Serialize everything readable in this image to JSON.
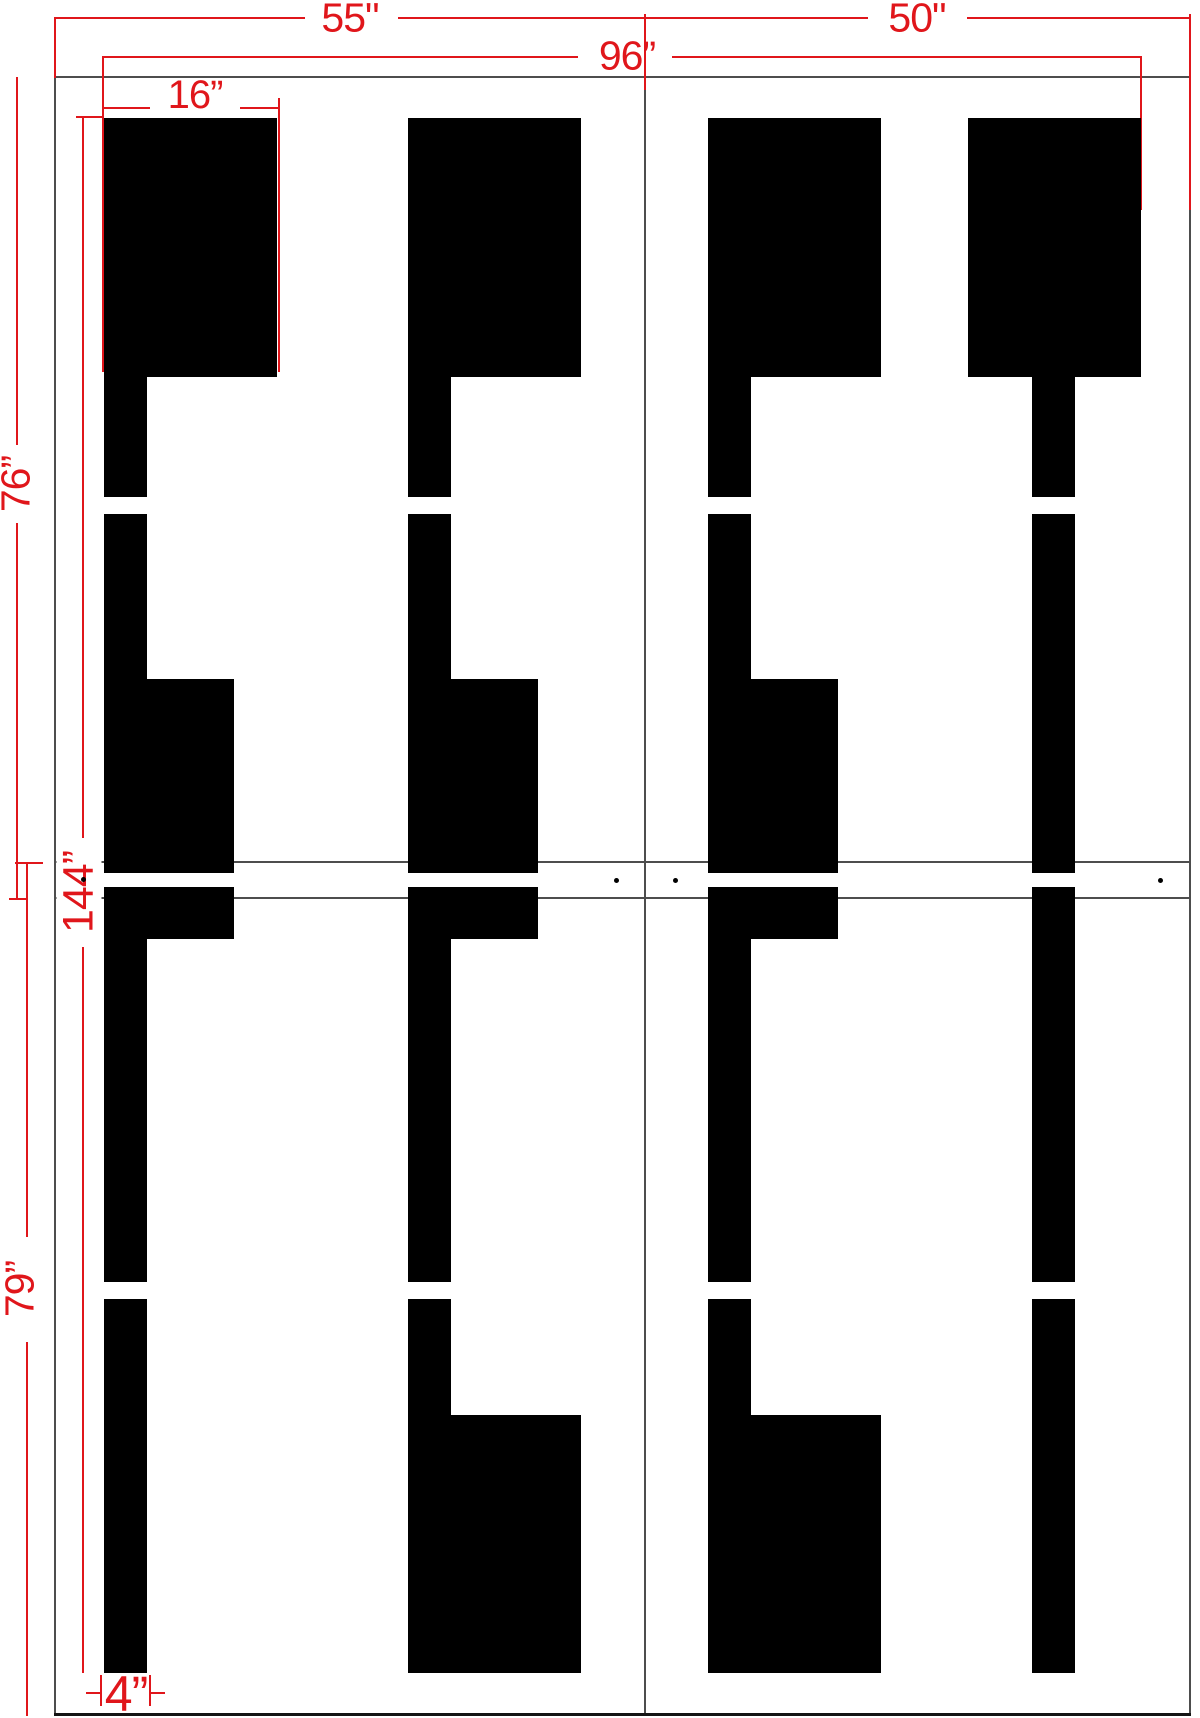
{
  "diagram": {
    "type": "stencil-dimension-drawing",
    "word": "FEET",
    "units": "inches",
    "canvas": {
      "w": 1200,
      "h": 1718
    },
    "colors": {
      "dimension_red": "#e0161b",
      "sheet_line_gray": "#4d4d4d",
      "bottom_edge_dark": "#141414",
      "shape_black": "#000000",
      "background": "#ffffff"
    },
    "dimension_labels": {
      "sheet_left_width": "55\"",
      "sheet_right_width": "50\"",
      "message_width": "96”",
      "letter_top_width": "16”",
      "top_sheet_height": "76”",
      "letter_height": "144”",
      "bottom_sheet_height": "79”",
      "letter_stroke_width": "4”"
    },
    "labels": [
      {
        "key": "sheet_left_width",
        "x": 350,
        "y": 18,
        "rot": 0,
        "size": 41,
        "bg": false
      },
      {
        "key": "sheet_right_width",
        "x": 917,
        "y": 18,
        "rot": 0,
        "size": 41,
        "bg": false
      },
      {
        "key": "message_width",
        "x": 627,
        "y": 56,
        "rot": 0,
        "size": 41,
        "bg": false
      },
      {
        "key": "letter_top_width",
        "x": 195,
        "y": 95,
        "rot": 0,
        "size": 40,
        "bg": false
      },
      {
        "key": "top_sheet_height",
        "x": 16,
        "y": 484,
        "rot": -90,
        "size": 41,
        "bg": true
      },
      {
        "key": "letter_height",
        "x": 79,
        "y": 892,
        "rot": -90,
        "size": 43,
        "bg": true
      },
      {
        "key": "bottom_sheet_height",
        "x": 20,
        "y": 1289,
        "rot": -90,
        "size": 41,
        "bg": true
      },
      {
        "key": "letter_stroke_width",
        "x": 126,
        "y": 1694,
        "rot": 0,
        "size": 50,
        "bg": false
      }
    ],
    "geometry": {
      "sheet_lines": [
        [
          54,
          76,
          1137,
          2
        ],
        [
          54,
          861,
          1137,
          2
        ],
        [
          54,
          897,
          1137,
          2
        ],
        [
          54,
          76,
          2,
          1640
        ],
        [
          644,
          76,
          2,
          1640
        ],
        [
          1189,
          76,
          2,
          1640
        ]
      ],
      "edge_lines": [
        [
          54,
          1713,
          1137,
          3
        ]
      ],
      "dim_lines": [
        [
          54,
          17,
          251,
          2
        ],
        [
          398,
          17,
          247,
          2
        ],
        [
          645,
          17,
          223,
          2
        ],
        [
          967,
          17,
          223,
          2
        ],
        [
          103,
          56,
          475,
          2
        ],
        [
          672,
          56,
          469,
          2
        ],
        [
          104,
          107,
          46,
          2
        ],
        [
          240,
          107,
          39,
          2
        ],
        [
          86,
          1692,
          14,
          2
        ],
        [
          151,
          1692,
          14,
          2
        ],
        [
          76,
          116,
          28,
          2
        ],
        [
          15,
          862,
          28,
          2
        ],
        [
          9,
          898,
          18,
          2
        ],
        [
          54,
          17,
          2,
          61
        ],
        [
          644,
          14,
          2,
          76
        ],
        [
          1189,
          14,
          2,
          196
        ],
        [
          102,
          56,
          2,
          316
        ],
        [
          278,
          98,
          2,
          274
        ],
        [
          1140,
          56,
          2,
          154
        ],
        [
          16,
          77,
          2,
          368
        ],
        [
          16,
          523,
          2,
          376
        ],
        [
          82,
          117,
          2,
          721
        ],
        [
          82,
          947,
          2,
          726
        ],
        [
          26,
          862,
          2,
          375
        ],
        [
          26,
          1342,
          2,
          374
        ],
        [
          100,
          1675,
          2,
          31
        ],
        [
          149,
          1675,
          2,
          31
        ]
      ],
      "shapes": [
        {
          "letter": "F",
          "parts": [
            [
              104,
              118,
              173,
              259
            ],
            [
              104,
              377,
              43,
              120
            ],
            [
              104,
              514,
              43,
              165
            ],
            [
              104,
              679,
              130,
              194
            ],
            [
              104,
              887,
              130,
              52
            ],
            [
              104,
              939,
              43,
              343
            ],
            [
              104,
              1299,
              43,
              374
            ]
          ]
        },
        {
          "letter": "E1",
          "parts": [
            [
              408,
              118,
              173,
              259
            ],
            [
              408,
              377,
              43,
              120
            ],
            [
              408,
              514,
              43,
              165
            ],
            [
              408,
              679,
              130,
              194
            ],
            [
              408,
              887,
              130,
              52
            ],
            [
              408,
              939,
              43,
              343
            ],
            [
              408,
              1299,
              43,
              116
            ],
            [
              408,
              1415,
              173,
              258
            ]
          ]
        },
        {
          "letter": "E2",
          "parts": [
            [
              708,
              118,
              173,
              259
            ],
            [
              708,
              377,
              43,
              120
            ],
            [
              708,
              514,
              43,
              165
            ],
            [
              708,
              679,
              130,
              194
            ],
            [
              708,
              887,
              130,
              52
            ],
            [
              708,
              939,
              43,
              343
            ],
            [
              708,
              1299,
              43,
              116
            ],
            [
              708,
              1415,
              173,
              258
            ]
          ]
        },
        {
          "letter": "T",
          "parts": [
            [
              968,
              118,
              173,
              259
            ],
            [
              1032,
              377,
              43,
              120
            ],
            [
              1032,
              514,
              43,
              359
            ],
            [
              1032,
              887,
              43,
              395
            ],
            [
              1032,
              1299,
              43,
              374
            ]
          ]
        }
      ],
      "dots": [
        [
          83,
          879
        ],
        [
          616,
          880
        ],
        [
          675,
          880
        ],
        [
          1160,
          880
        ]
      ]
    }
  }
}
